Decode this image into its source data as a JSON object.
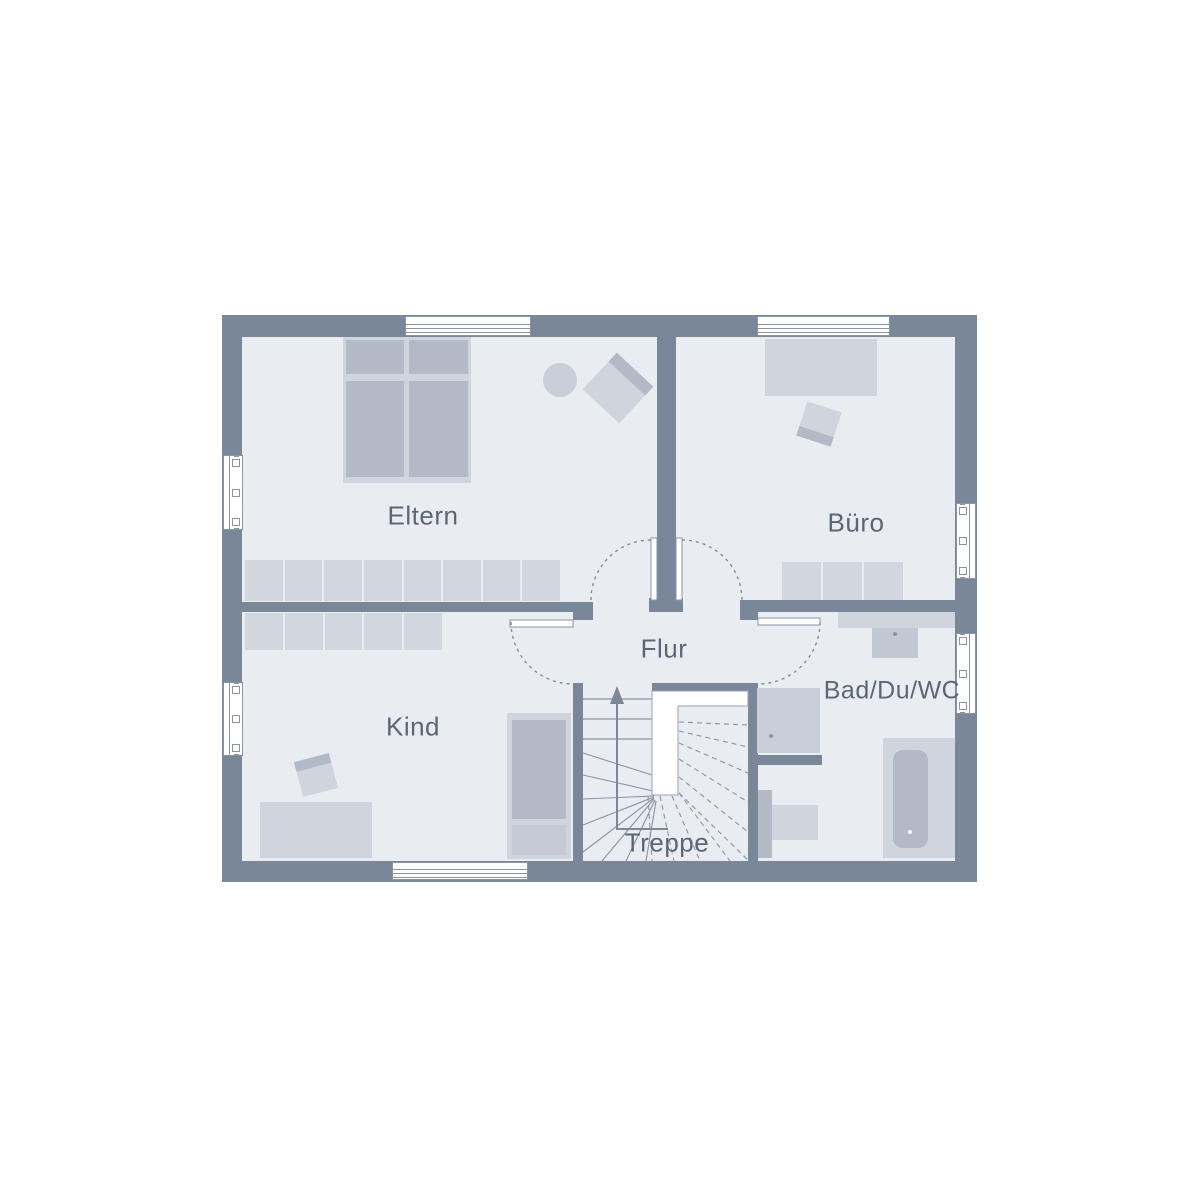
{
  "rooms": {
    "eltern": {
      "label": "Eltern"
    },
    "buero": {
      "label": "Büro"
    },
    "flur": {
      "label": "Flur"
    },
    "kind": {
      "label": "Kind"
    },
    "bad": {
      "label": "Bad/Du/WC"
    },
    "treppe": {
      "label": "Treppe"
    }
  },
  "furniture": {
    "eltern": [
      "double-bed",
      "wardrobe-row",
      "side-table",
      "chair"
    ],
    "buero": [
      "desk",
      "office-chair",
      "sideboard"
    ],
    "kind": [
      "wardrobe-row",
      "bed",
      "desk",
      "chair"
    ],
    "bad": [
      "vanity",
      "sink",
      "shower",
      "wc",
      "bathtub"
    ],
    "treppe": [
      "winder-staircase",
      "up-arrow-walkline"
    ]
  },
  "colors": {
    "background": "#ffffff",
    "wall": "#7a8799",
    "floor": "#e9ecf0",
    "furniture_light": "#cfd4dd",
    "furniture_medium": "#b3b9c6",
    "closet": "#d2d6df",
    "line": "#8b94a4",
    "label_text": "#5c6776"
  }
}
